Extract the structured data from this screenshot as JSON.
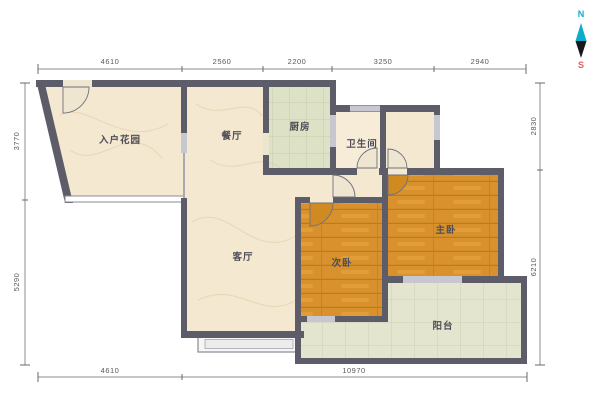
{
  "title": "apartment-floor-plan",
  "compass": {
    "north_label": "N",
    "south_label": "S"
  },
  "rooms": [
    {
      "id": "entry_garden",
      "label": "入户花园"
    },
    {
      "id": "dining",
      "label": "餐厅"
    },
    {
      "id": "kitchen",
      "label": "厨房"
    },
    {
      "id": "bathroom",
      "label": "卫生间"
    },
    {
      "id": "living",
      "label": "客厅"
    },
    {
      "id": "second_bedroom",
      "label": "次卧"
    },
    {
      "id": "master_bedroom",
      "label": "主卧"
    },
    {
      "id": "balcony",
      "label": "阳台"
    }
  ],
  "dimensions": {
    "top": [
      "4610",
      "2560",
      "2200",
      "3250",
      "2940"
    ],
    "bottom": [
      "4610",
      "10970"
    ],
    "left": [
      "3770",
      "5290"
    ],
    "right": [
      "2830",
      "6210"
    ]
  },
  "colors": {
    "wall": "#5d5d69",
    "marble_floor": "#f4e8d1",
    "kitchen_tile": "#dde2c6",
    "balcony_tile": "#e3e5cf",
    "wood_floor": "#d8912c",
    "compass_north": "#0aaecb",
    "compass_south": "#e06060",
    "dimension_text": "#5a5a5a"
  }
}
